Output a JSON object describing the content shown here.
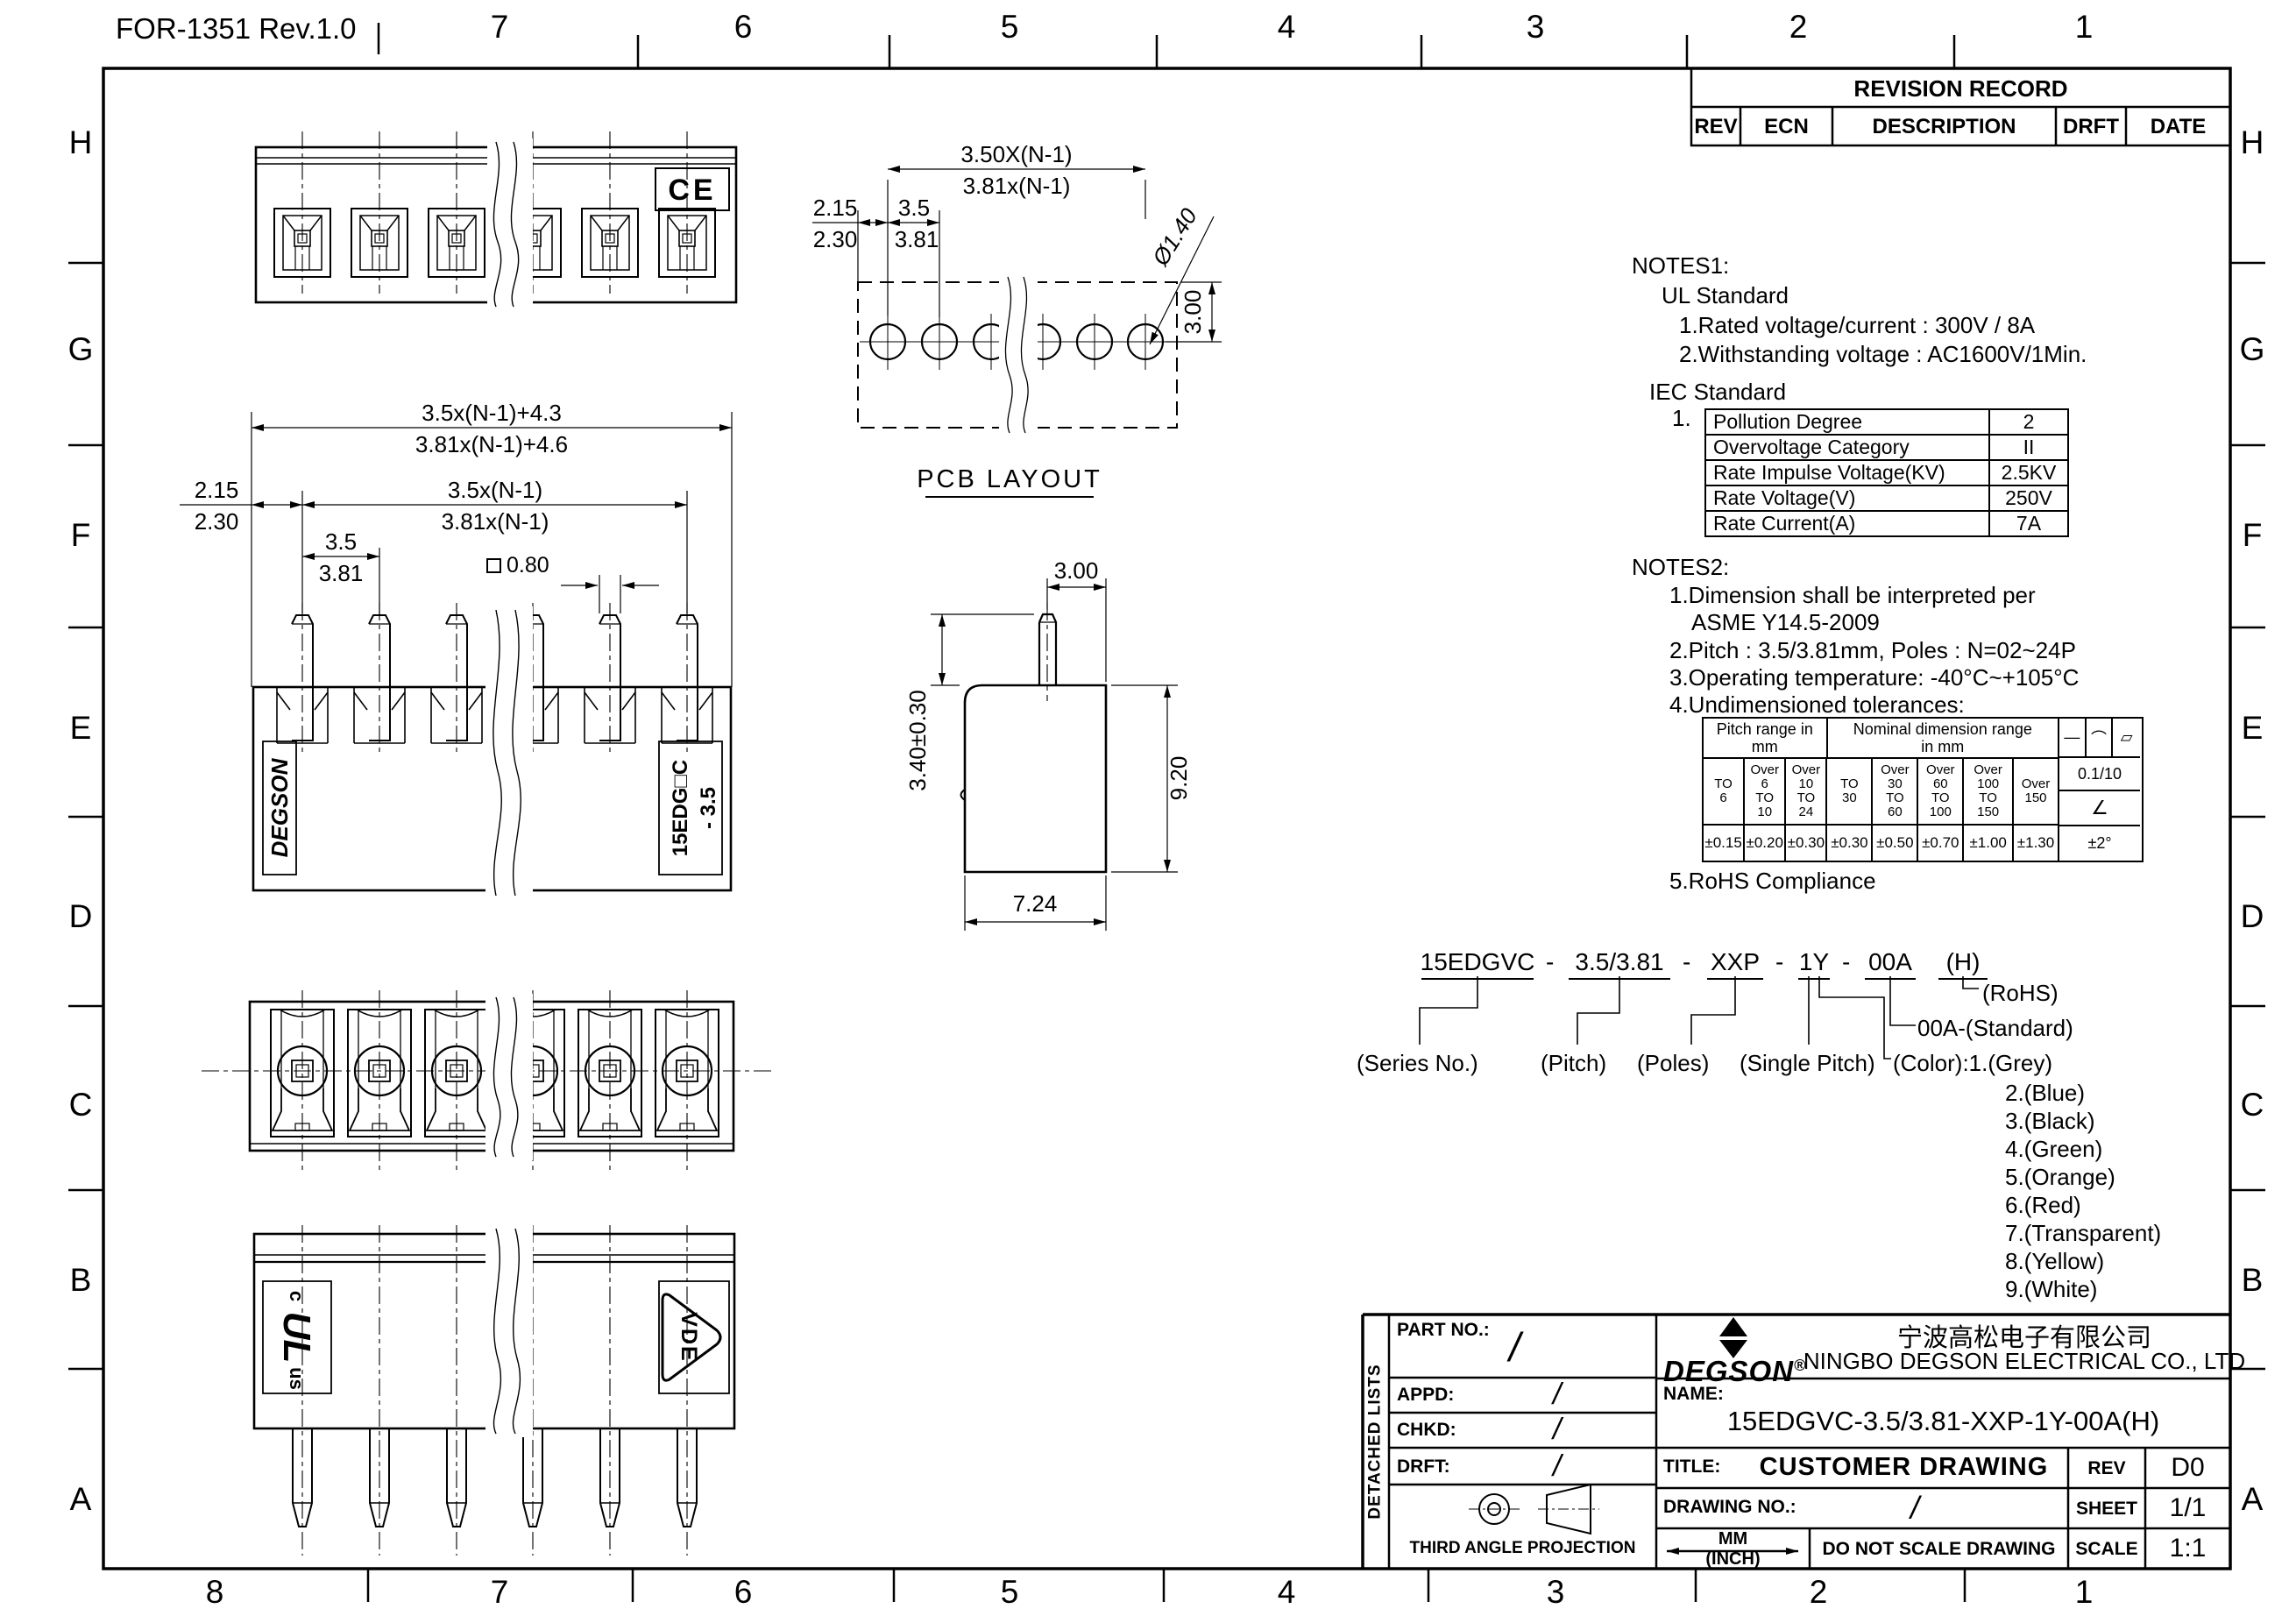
{
  "meta": {
    "form_title": "FOR-1351 Rev.1.0",
    "grid_letters": [
      "H",
      "G",
      "F",
      "E",
      "D",
      "C",
      "B",
      "A"
    ],
    "top_numbers": [
      "7",
      "6",
      "5",
      "4",
      "3",
      "2",
      "1"
    ],
    "bottom_numbers": [
      "8",
      "7",
      "6",
      "5",
      "4",
      "3",
      "2",
      "1"
    ]
  },
  "revision": {
    "title": "REVISION RECORD",
    "col_rev": "REV",
    "col_ecn": "ECN",
    "col_desc": "DESCRIPTION",
    "col_drft": "DRFT",
    "col_date": "DATE"
  },
  "views": {
    "top": {
      "ce": "CE"
    },
    "pcb": {
      "label": "PCB LAYOUT",
      "dim_overall_a": "3.50X(N-1)",
      "dim_overall_b": "3.81x(N-1)",
      "dim_edge_a": "2.15",
      "dim_edge_b": "2.30",
      "dim_pitch_a": "3.5",
      "dim_pitch_b": "3.81",
      "dim_hole": "Ø1.40",
      "dim_row": "3.00"
    },
    "front": {
      "dim_len_a": "3.5x(N-1)+4.3",
      "dim_len_b": "3.81x(N-1)+4.6",
      "dim_span_a": "3.5x(N-1)",
      "dim_span_b": "3.81x(N-1)",
      "dim_edge_a": "2.15",
      "dim_edge_b": "2.30",
      "dim_pitch_a": "3.5",
      "dim_pitch_b": "3.81",
      "dim_pin": "0.80",
      "brand": "DEGSON",
      "part_line1": "15EDG□C",
      "part_line2": "- 3.5"
    },
    "side": {
      "dim_top": "3.00",
      "dim_pin_h": "3.40±0.30",
      "dim_body_h": "9.20",
      "dim_body_w": "7.24"
    },
    "bottom": {
      "ul_c": "c",
      "ul_mark": "UL",
      "ul_us": "us",
      "vde": "VDE"
    }
  },
  "notes1": {
    "heading": "NOTES1:",
    "ul_title": "UL Standard",
    "ul_1": "1.Rated voltage/current : 300V / 8A",
    "ul_2": "2.Withstanding voltage : AC1600V/1Min.",
    "iec_title": "IEC Standard",
    "iec_no": "1.",
    "rows": [
      [
        "Pollution Degree",
        "2"
      ],
      [
        "Overvoltage Category",
        "II"
      ],
      [
        "Rate Impulse Voltage(KV)",
        "2.5KV"
      ],
      [
        "Rate Voltage(V)",
        "250V"
      ],
      [
        "Rate Current(A)",
        "7A"
      ]
    ]
  },
  "notes2": {
    "heading": "NOTES2:",
    "l1": "1.Dimension shall be interpreted per",
    "l1b": "ASME Y14.5-2009",
    "l2": "2.Pitch : 3.5/3.81mm, Poles : N=02~24P",
    "l3": "3.Operating temperature: -40°C~+105°C",
    "l4": "4.Undimensioned tolerances:",
    "l5": "5.RoHS Compliance",
    "tol": {
      "pitch_hdr": "Pitch range in\nmm",
      "nom_hdr": "Nominal dimension range\nin mm",
      "sym_line": "—",
      "sym_arc": "⌒",
      "sym_flat": "▱",
      "p1": "TO\n6",
      "p2": "Over\n6\nTO\n10",
      "p3": "Over\n10\nTO\n24",
      "n1": "TO\n30",
      "n2": "Over\n30\nTO\n60",
      "n3": "Over\n60\nTO\n100",
      "n4": "Over\n100\nTO\n150",
      "n5": "Over\n150",
      "v_straight": "0.1/10",
      "v_angle_sym": "∠",
      "pt1": "±0.15",
      "pt2": "±0.20",
      "pt3": "±0.30",
      "nt1": "±0.30",
      "nt2": "±0.50",
      "nt3": "±0.70",
      "nt4": "±1.00",
      "nt5": "±1.30",
      "v_deg": "±2°"
    }
  },
  "ordering": {
    "seg1": "15EDGVC",
    "d1": "-",
    "seg2": "3.5/3.81",
    "d2": "-",
    "seg3": "XXP",
    "d3": "-",
    "seg4": "1Y",
    "d4": "-",
    "seg5": "00A",
    "seg6": "(H)",
    "lbl_series": "(Series No.)",
    "lbl_pitch": "(Pitch)",
    "lbl_poles": "(Poles)",
    "lbl_single": "(Single Pitch)",
    "rohs": "(RoHS)",
    "standard": "00A-(Standard)",
    "color_first": "(Color):1.(Grey)",
    "colors": [
      "2.(Blue)",
      "3.(Black)",
      "4.(Green)",
      "5.(Orange)",
      "6.(Red)",
      "7.(Transparent)",
      "8.(Yellow)",
      "9.(White)"
    ]
  },
  "title_block": {
    "detached": "DETACHED LISTS",
    "part_no": "PART NO.:",
    "appd": "APPD:",
    "chkd": "CHKD:",
    "drft": "DRFT:",
    "slash": "/",
    "projection": "THIRD ANGLE PROJECTION",
    "logo": "DEGSON",
    "reg": "®",
    "company_cn": "宁波高松电子有限公司",
    "company_en": "NINGBO DEGSON ELECTRICAL CO., LTD",
    "name_lbl": "NAME:",
    "name_val": "15EDGVC-3.5/3.81-XXP-1Y-00A(H)",
    "title_lbl": "TITLE:",
    "title_val": "CUSTOMER DRAWING",
    "rev_lbl": "REV",
    "rev_val": "D0",
    "dwg_lbl": "DRAWING NO.:",
    "sheet_lbl": "SHEET",
    "sheet_val": "1/1",
    "mm": "MM",
    "inch": "(INCH)",
    "no_scale": "DO NOT SCALE DRAWING",
    "scale_lbl": "SCALE",
    "scale_val": "1:1"
  }
}
